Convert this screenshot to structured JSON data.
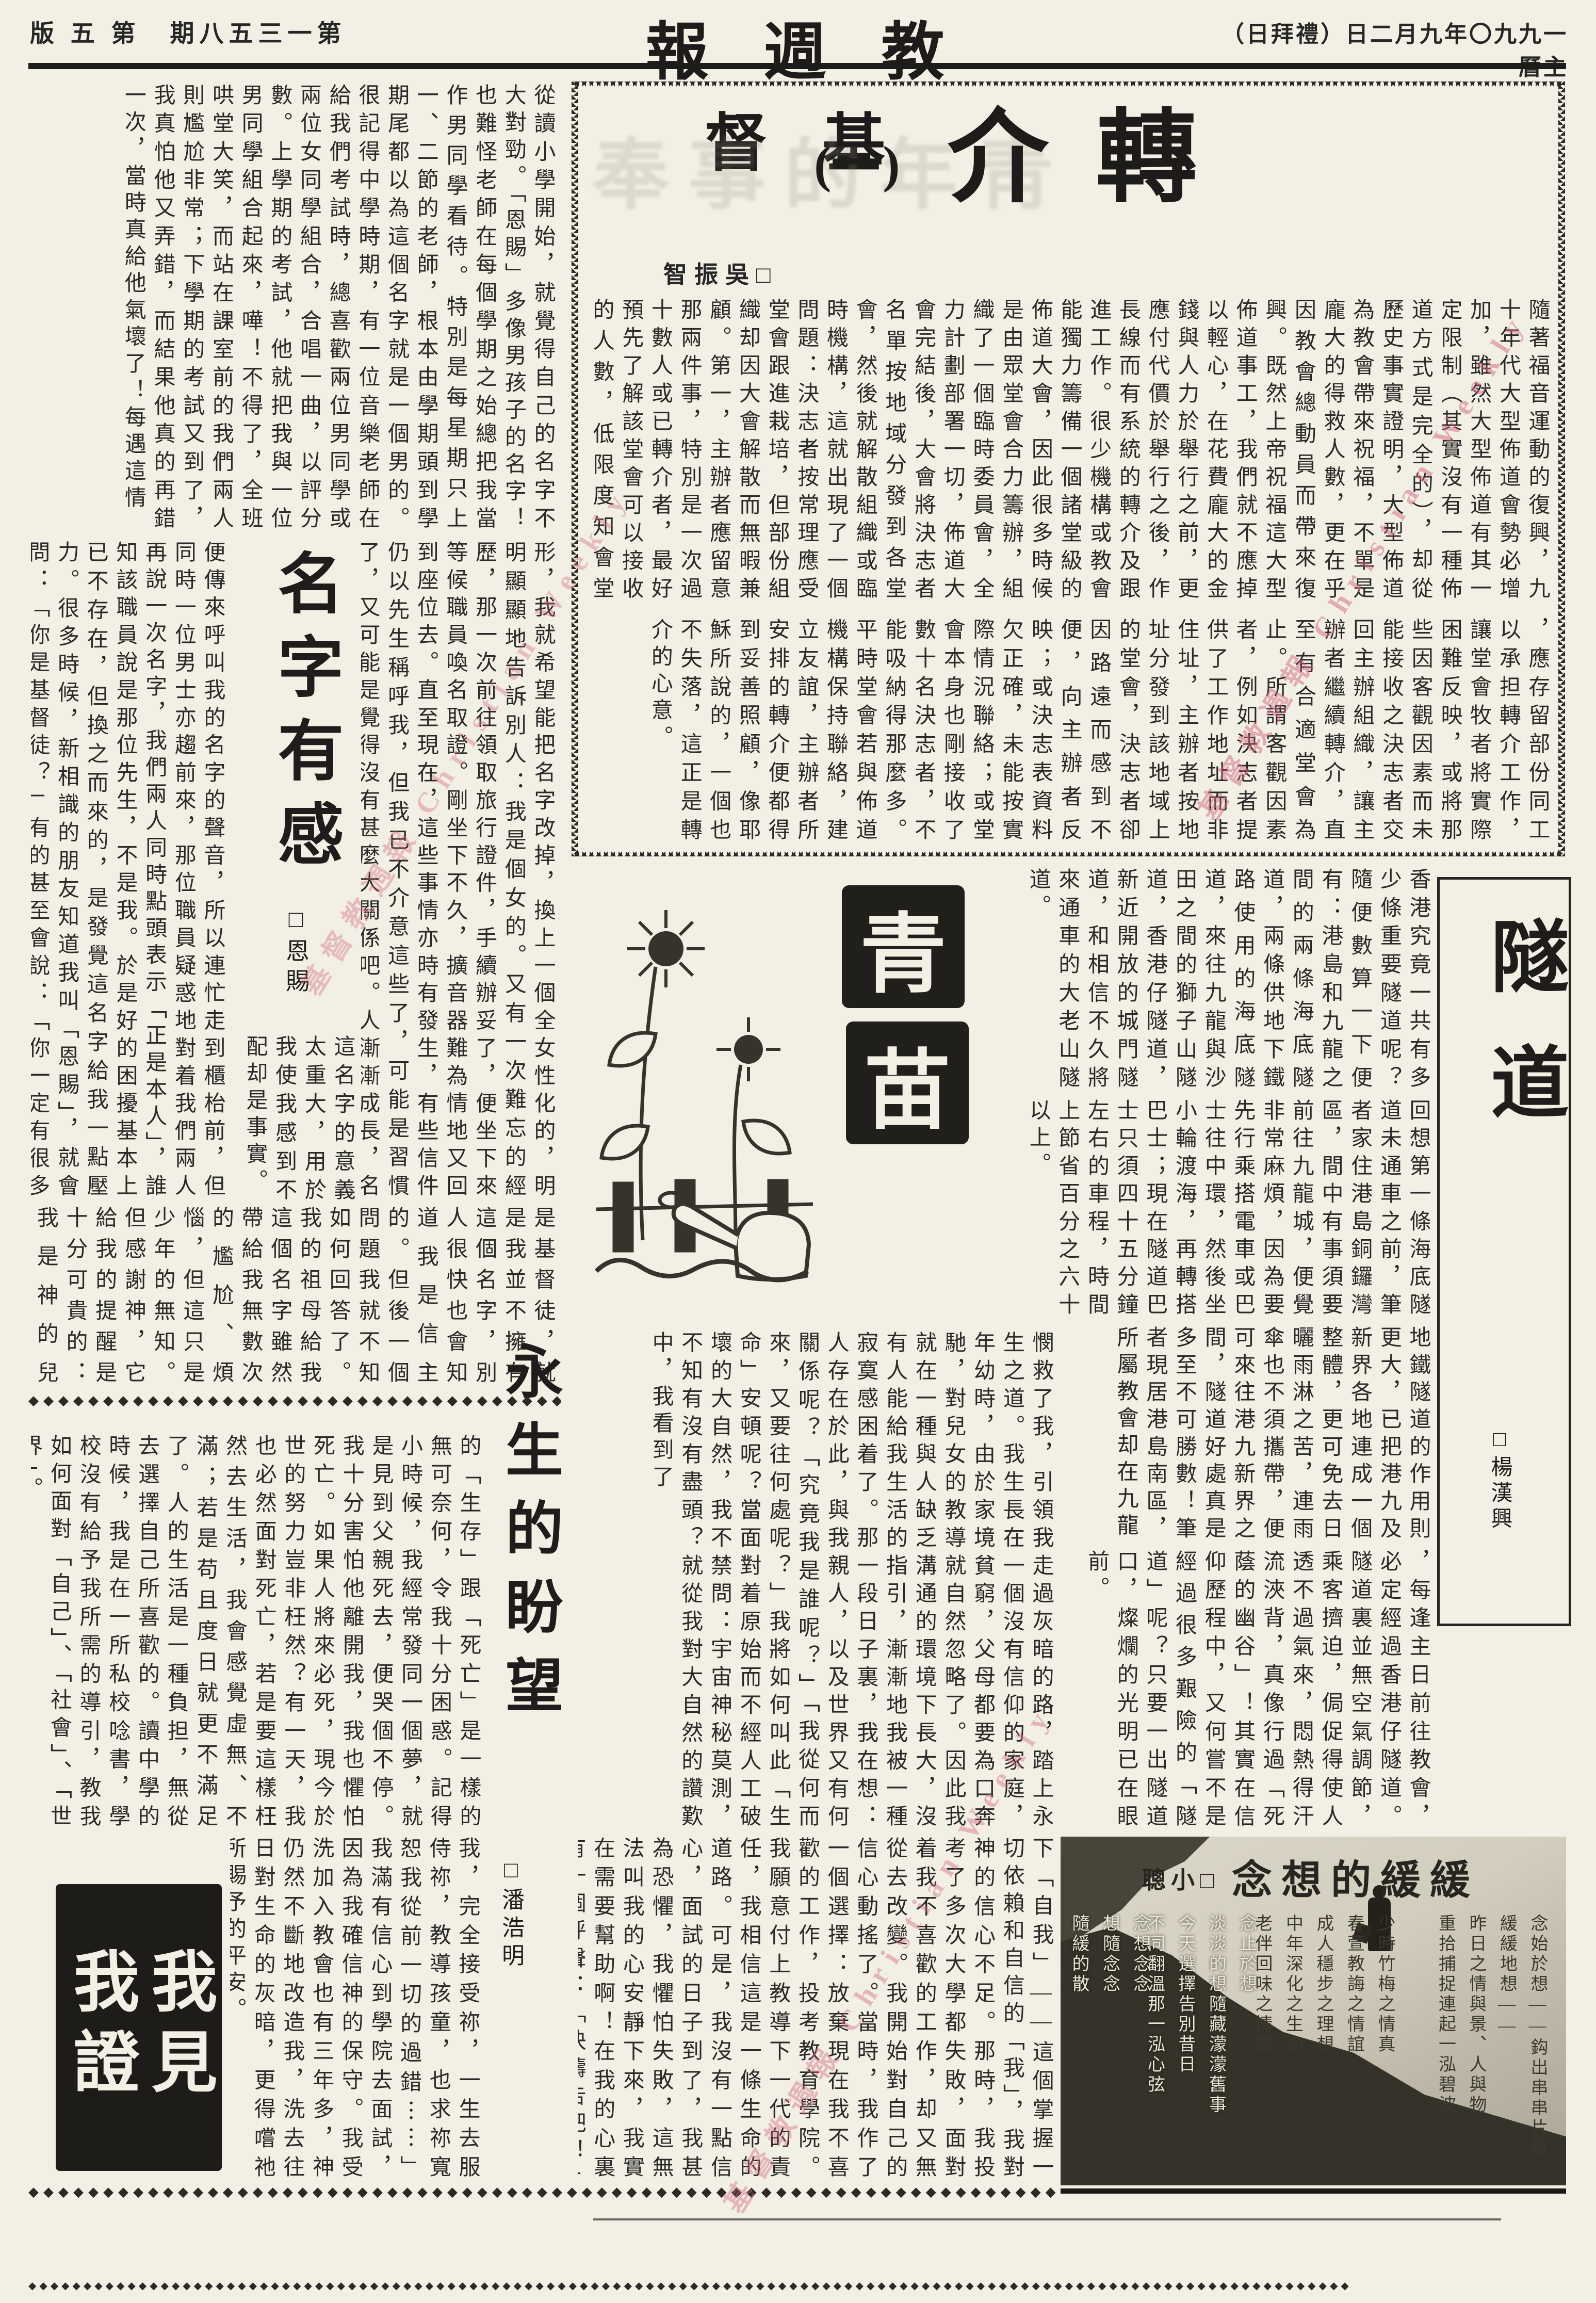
{
  "page": {
    "edition_display": "版 五 第　期八五三一第",
    "masthead_display": "報 週 教 督 基",
    "date_display": "（日拜禮）日二月九年〇九九一曆主",
    "watermark": "基督教週報 Christian Weekly"
  },
  "zhuan": {
    "title_char1": "轉",
    "title_char2": "介",
    "title_part": "(一)",
    "author_display": "智振吳□",
    "ghost_display": "奉事的年靑",
    "band1": "隨著福音運動的復興，九十年代大型佈道會勢必增加，雖然大型佈道有其一定限制（其實沒有一種佈道方式是完全的），却從歷史事實證明，大型佈道為教會帶來祝福，不單是龐大的得救人數，更在乎因教會總動員而帶來復興。既然上帝祝福這大型佈道事工，我們就不應掉以輕心，在花費龐大的金錢與人力於舉行之前，更應付代價於舉行之後，作長線而有系統的轉介及跟進工作。很少機構或教會能獨力籌備一個諸堂級的佈道大會，因此很多時候是由眾堂會合力籌辦，組織了一個臨時委員會，全力計劃部署一切，佈道大會完結後，大會將決志者名單按地域分發到各堂會，然後就解散組織或臨時機構，這就出現了一個問題：決志者按常理應受堂會跟進栽培，但部份組織却因大會解散而無暇兼顧。第一，主辦者應留意那兩件事，特別是一次過十數人或已轉介者，最好預先了解該堂會可以接收的人數，低限度知會堂會，予他們請及早作準備。第二就是主辦者最好在佈道會之後",
    "band2": "，應存留部份同工以承担轉介工作，讓堂會牧者將實際困難反映，或將那些因客觀因素而未能接收之決志者交回主辦組織，讓主辦者繼續轉介，直至有合適堂會為止。所謂客觀因素者，例如決志者提供了工作地址而非住址，主辦者按地址分發到該地域上的堂會，決志者卻因路遠而感到不便，向主辦者反映；或決志表資料欠正確，未能按實際情況聯絡；或堂會本身也剛接收了數十名決志者，不能吸納得那麼多。平時堂會若與佈道機構保持聯絡，建立友誼，主辦者所安排的轉介便都得到妥善照顧，像耶穌所說的，一個也不失落，這正是轉介的心意。"
  },
  "ming": {
    "title": "名字有感",
    "author": "□恩賜",
    "bandA": "從讀小學開始，就覺得自己的名字不大對勁。「恩賜」多像男孩子的名字！也難怪老師在每個學期之始總把我當作男同學看待。特別是每星期只上一、二節的老師，根本由學期頭到學期尾都以為這個名字就是一個男的。很記得中學時期，有一位音樂老師在給我們考試時，總喜歡兩位男同學或兩位女同學組合，合唱一曲，以評分數。上學期的考試，他就把我與一位男同學組合起來，嘩！不得了，全班哄堂大笑，而站在課室前的我們兩人則尷尬非常；下學期的考試又到了，我真怕他又弄錯，而結果他真的再錯一次，當時真給他氣壞了！每遇這情",
    "right_col": "形，我就希望能把名字改掉，換上一個全女性化的，明明顯顯地告訴別人：我是個女的。又有一次難忘的經歷，那一次前往領取旅行證件，手續辦妥了，便坐下來等候職員喚名取證。剛坐下不久，擴音器難為情地又回到座位去。直至現在，這些事情亦時有發生，有些信件仍以先生稱呼我，但我已不介意這些了，可能是習慣了，又可能是覺得沒有甚麼大關係吧。人漸漸成長，名字帶給我",
    "left_col": "便傳來呼叫我的名字的聲音，所以連忙走到櫃枱前，但同時一位男士亦趨前來，那位職員疑惑地對着我們兩人再說一次名字，我們兩人同時點頭表示「正是本人」，誰知該職員說是那位先生，不是我。於是好的困擾基本上已不存在，但換之而來的，是發覺這名字給我一點壓力。很多時候，新相識的朋友知道我叫「恩賜」，就會問：「你是基督徒？」有的甚至會說：「你一定有很多恩賜了。」是的，我",
    "mid_tail": "這名字的意義太重大，用於我使我感到不配却是事實。",
    "bandC": "是基督徒，就是我並不擁有這個名字，別人很快也會知道我是信主的。但後一個問題我就不知如何回答了。我的祖母給我這個名字雖然帶給我無數次的尷尬、煩惱，但這只是少年的無知。但感謝神，它給我的提醒是十分可貴的：我是神的兒女、是屬祂的，祂是我的主；我生活、工作的力量也是從祂而來，離了祂我就不能作甚麼。"
  },
  "qing": {
    "char1": "青",
    "char2": "苗"
  },
  "sui": {
    "title": "隧道",
    "author": "□楊漢興",
    "band1": "香港究竟一共有多少條重要隧道呢？隨便數算一下便有：港島和九龍之間的兩條海底隧道，兩條供地下鐵路使用的海底隧道，來往九龍與沙田之間的獅子山隧道，香港仔隧道，新近開放的城門隧道，和相信不久將來通車的大老山隧道。",
    "band2": "回想第一條海底隧道未通車之前，筆者家住港島銅鑼灣區，間中有事須要前往九龍城，便覺非常麻煩，因為要先行乘搭電車或巴士往中環，然後坐小輪渡海，再轉搭巴士；現在隧道巴士只須四十五分鐘左右的車程，時間上節省百分之六十以上。",
    "band3": "地鐵隧道的作用則更大，已把港九及新界各地連成一個整體，更可免去日曬雨淋之苦，連雨傘也不須攜帶，便可來往港九新界之間，隧道好處真是多至不可勝數！筆者現居港島南區，所屬教會却在九龍",
    "band4": "，每逢主日前往教會，必定經過香港仔隧道。隧道裏並無空氣調節，乘客擠迫，侷促得使人透不過氣來，悶熱得汗流浹背，真像行過「死蔭的幽谷」！其實在信仰歷程中，又何嘗不是經過很多艱險的「隧道」呢？只要一出隧道口，燦爛的光明已在眼前。"
  },
  "yong": {
    "title": "永生的盼望",
    "author": "□潘浩明",
    "right_band": "憫救了我，引領我走過灰暗的路，踏上永生之道。我生長在一個沒有信仰的家庭，年幼時，由於家境貧窮，父母都要為口奔馳，對兒女的教導就自然忽略了。因此我就在一種與人缺乏溝通的環境下長大，沒有人能給我生活的指引，漸漸地我被一種寂寞感困着了。那一段日子裏，我在想：人存在於此，與我親人，以及世界又有何關係呢？「究竟我是誰呢？」「我從何而來，又要往何處呢？」我將如何叫此「生命」安頓呢？當面對着原始而不經人工破壞的大自然，我不禁問：宇宙神秘莫測，不知有沒有盡頭？就從我對大自然的讚歎中，我看到了",
    "left_band": "的「生存」跟「死亡」是一樣的無可奈何，令我十分困惑。記得小時候，我經常發同一個夢，就是見到父親死去，便哭個不停。我十分害怕他離開我，我也懼怕死亡。如果人將來必死，現今於世的努力豈非枉然？有一天，我也必然面對死亡，若是要這樣枉然去生活，我會感覺虛無、不滿；若是苟且度日就更不滿足了。人的生活是一種負担，無從去選擇自己所喜歡的。讀中學的時候，我是在一所私校唸書，學校沒有給予我所需的導引，教我如何面對「自己」、「社會」、「世界」。",
    "bottom_right": "下「自我」——這個掌握一切依賴和自信的「我」，我對神的信心不足。那時，我投考了多次大學都失敗，面對着我不喜歡的工作，却又無從去改變。我開始對自己的信心動搖了。當時，我作了一個選擇：放棄現在我不喜歡的工作，投考教育學院。我願意付上教導下一代的責任，我相信這是一條生命的道路。可是，我沒有一點信心，面試的日子到了，我甚為恐懼，我懼怕失敗，這無法叫我的心安靜下來，我實在需要幫助啊！在我的心裏有一個呼聲：「快禱告吧！」我對神說：「我願意放下自",
    "bottom_left": "我，完全接受祢，一生去服侍祢，教導孩童，也求祢寬恕我從前一切的過錯⋯⋯」我滿有信心到學院去面試，因為我確信神的保守。我受洗加入教會也有三年多，神仍然不斷地改造我，洗去往日對生命的灰暗，更得嚐祂所賜予的平安。"
  },
  "witness": {
    "logo_display": "我見\n我證"
  },
  "huan": {
    "title_display": "念想的緩緩",
    "author_display": "聰小□",
    "poem_g1": "念始於想——鈎出串串片段\n緩緩地想——\n昨日之情與景、人與物\n重拾捕捉連起一泓碧波",
    "poem_g2": "少時竹梅之情真\n春萱教誨之情誼\n成人穩步之理想\n中年深化之生命\n老伴回味之情懷",
    "poem_g3": "念止於想\n淡淡的想隨藏濛濛舊事\n今天選擇告別昔日\n不同翻溫那一泓心弦",
    "poem_g4": "念想念念\n想隨念念\n隨緩的散\n緩緩的想\n散盡於想念間之一絲情"
  }
}
